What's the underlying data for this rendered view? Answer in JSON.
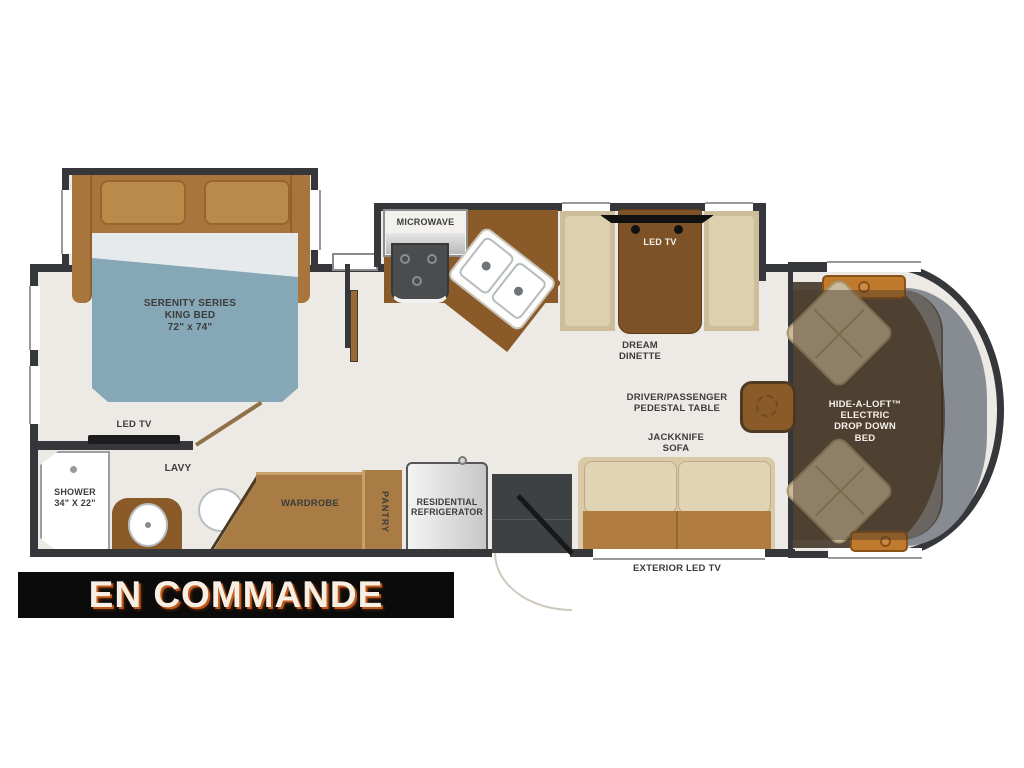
{
  "banner": {
    "label": "EN COMMANDE"
  },
  "colors": {
    "floor": "#edeae5",
    "wall": "#35373a",
    "cabinet_brown": "#8a5a28",
    "wood_tan": "#a87c44",
    "bed_blue": "#85a7b6",
    "sofa_tan": "#d9cba8",
    "banner_bg": "#0b0b0b",
    "banner_text": "#f7efe3",
    "banner_glow": "#c05a1c"
  },
  "rooms": {
    "bedroom": {
      "bed_line1": "SERENITY SERIES",
      "bed_line2": "KING BED",
      "bed_line3": "72\" x 74\"",
      "tv": "LED TV"
    },
    "bath": {
      "shower_line1": "SHOWER",
      "shower_line2": "34\" X 22\"",
      "lavy": "LAVY"
    },
    "storage": {
      "wardrobe": "WARDROBE",
      "pantry": "PANTRY",
      "fridge_line1": "RESIDENTIAL",
      "fridge_line2": "REFRIGERATOR"
    },
    "kitchen": {
      "microwave": "MICROWAVE"
    },
    "dinette": {
      "tv": "LED TV",
      "name_line1": "DREAM",
      "name_line2": "DINETTE"
    },
    "living": {
      "table_line1": "DRIVER/PASSENGER",
      "table_line2": "PEDESTAL TABLE",
      "sofa_line1": "JACKKNIFE",
      "sofa_line2": "SOFA",
      "exterior_tv": "EXTERIOR LED TV"
    },
    "cab": {
      "bed_line1": "HIDE-A-LOFT™",
      "bed_line2": "ELECTRIC",
      "bed_line3": "DROP DOWN",
      "bed_line4": "BED"
    }
  }
}
